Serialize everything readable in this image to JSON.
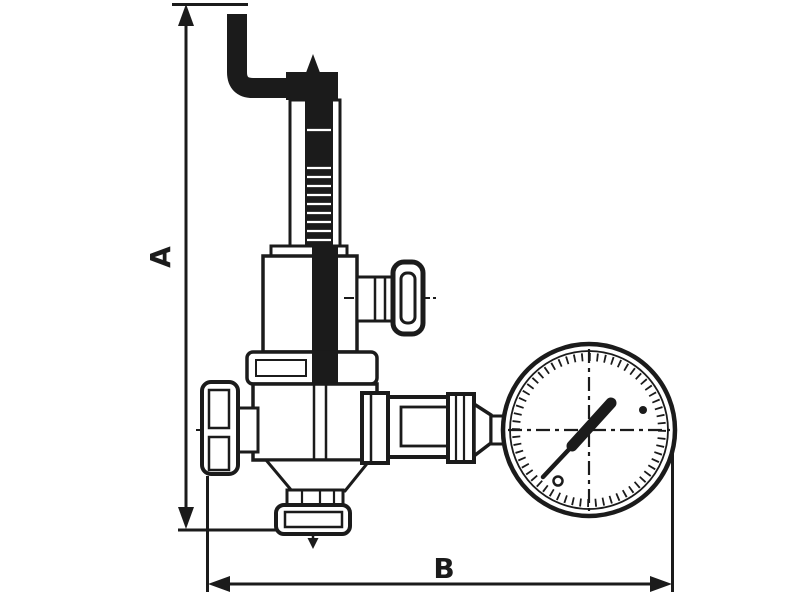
{
  "drawing": {
    "subject": "Pressure reducing valve with manometer - dimensional outline drawing",
    "stroke_color": "#1b1b1b",
    "background_color": "#ffffff",
    "labels": {
      "height_dimension": "A",
      "width_dimension": "B"
    },
    "components": [
      "bent-adjusting-pipe",
      "adjusting-screw-tip",
      "screw-cap",
      "spring-housing-tube",
      "threaded-spindle",
      "spring-bonnet",
      "tee-handle-side-valve",
      "top-flange",
      "valve-body",
      "inlet-union-nut",
      "outlet-bottom-flange",
      "flow-direction-arrow",
      "union-nut-to-gauge",
      "pressure-gauge",
      "gauge-needle"
    ]
  }
}
